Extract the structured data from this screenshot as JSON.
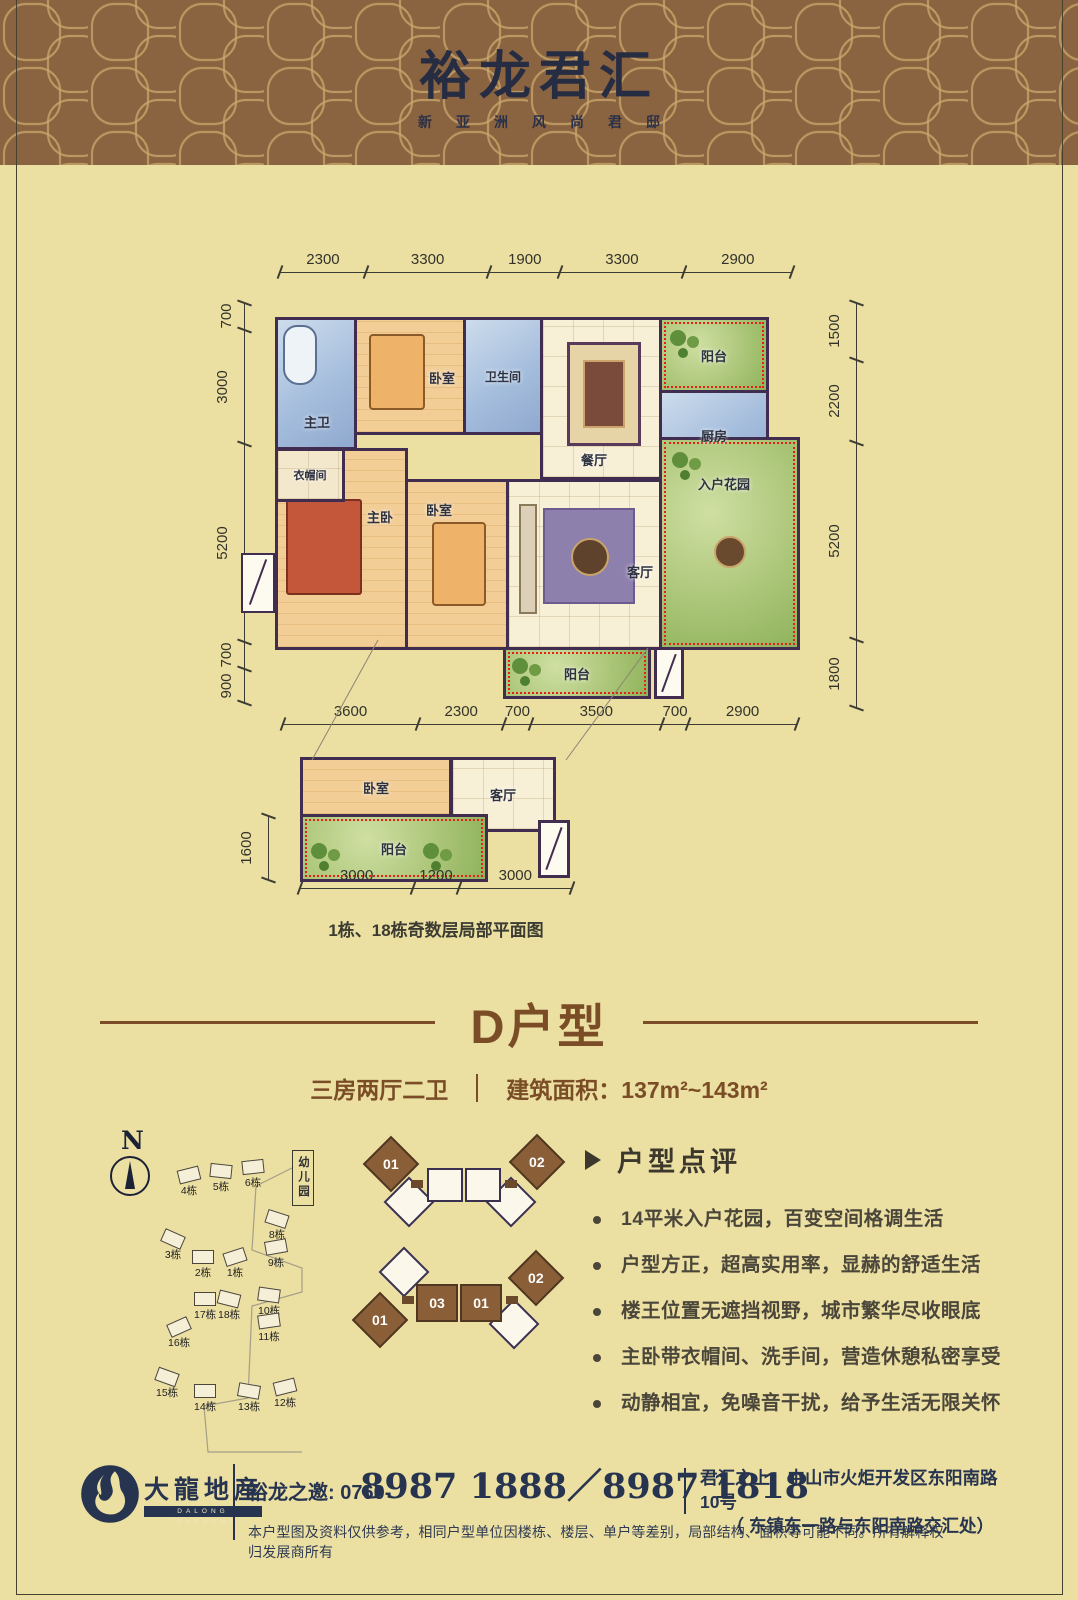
{
  "header": {
    "title": "裕龙君汇",
    "subtitle": "新亚洲风尚君邸"
  },
  "colors": {
    "band_brown": "#8a6341",
    "pattern_gold": "#c9a76a",
    "navy": "#273450",
    "title_brown": "#7b4d26",
    "accent_red": "#e42113",
    "page_bg": "#ebdfa2"
  },
  "plan": {
    "dims_top": [
      "2300",
      "3300",
      "1900",
      "3300",
      "2900"
    ],
    "dims_left": [
      "700",
      "3000",
      "5200",
      "700",
      "900"
    ],
    "dims_right": [
      "1500",
      "2200",
      "5200",
      "1800"
    ],
    "dims_bottom": [
      "3600",
      "2300",
      "700",
      "3500",
      "700",
      "2900"
    ],
    "rooms": {
      "master_bath": "主卫",
      "bedroom_top": "卧室",
      "bath2": "卫生间",
      "dining": "餐厅",
      "balcony_top": "阳台",
      "kitchen": "厨房",
      "cloak": "衣帽间",
      "master_bed": "主卧",
      "bedroom_mid": "卧室",
      "living": "客厅",
      "garden": "入户花园",
      "balcony_bottom": "阳台"
    }
  },
  "subplan": {
    "dims_left": [
      "1600"
    ],
    "dims_bottom": [
      "3000",
      "1200",
      "3000"
    ],
    "rooms": {
      "bedroom": "卧室",
      "living": "客厅",
      "balcony": "阳台"
    },
    "caption": "1栋、18栋奇数层局部平面图"
  },
  "unit": {
    "title": "D户型",
    "layout": "三房两厅二卫",
    "area": "建筑面积：137m²~143m²"
  },
  "sitemap": {
    "north": "N",
    "kindergarten": "幼儿园",
    "buildings": [
      "4栋",
      "5栋",
      "6栋",
      "3栋",
      "2栋",
      "1栋",
      "8栋",
      "9栋",
      "17栋",
      "18栋",
      "16栋",
      "10栋",
      "11栋",
      "15栋",
      "14栋",
      "13栋",
      "12栋"
    ]
  },
  "diagrams": {
    "a": {
      "d01": "01",
      "d02": "02"
    },
    "b": {
      "d01": "01",
      "m03": "03",
      "m01": "01",
      "d02": "02"
    }
  },
  "review": {
    "title": "户型点评",
    "bullets": [
      "14平米入户花园，百变空间格调生活",
      "户型方正，超高实用率，显赫的舒适生活",
      "楼王位置无遮挡视野，城市繁华尽收眼底",
      "主卧带衣帽间、洗手间，营造休憩私密享受",
      "动静相宜，免噪音干扰，给予生活无限关怀"
    ]
  },
  "footer": {
    "logo_cn": "大龍地産",
    "logo_en": "DALONG TENEMENT",
    "invite": "裕龙之邀: 0760-",
    "phones": "8987 1888／8987 1818",
    "address1": "君汇之上：中山市火炬开发区东阳南路10号",
    "address2": "（ 东镇东一路与东阳南路交汇处）",
    "disclaimer": "本户型图及资料仅供参考，相同户型单位因楼栋、楼层、单户等差别，局部结构、面积等可能不同。所有解释权归发展商所有"
  }
}
